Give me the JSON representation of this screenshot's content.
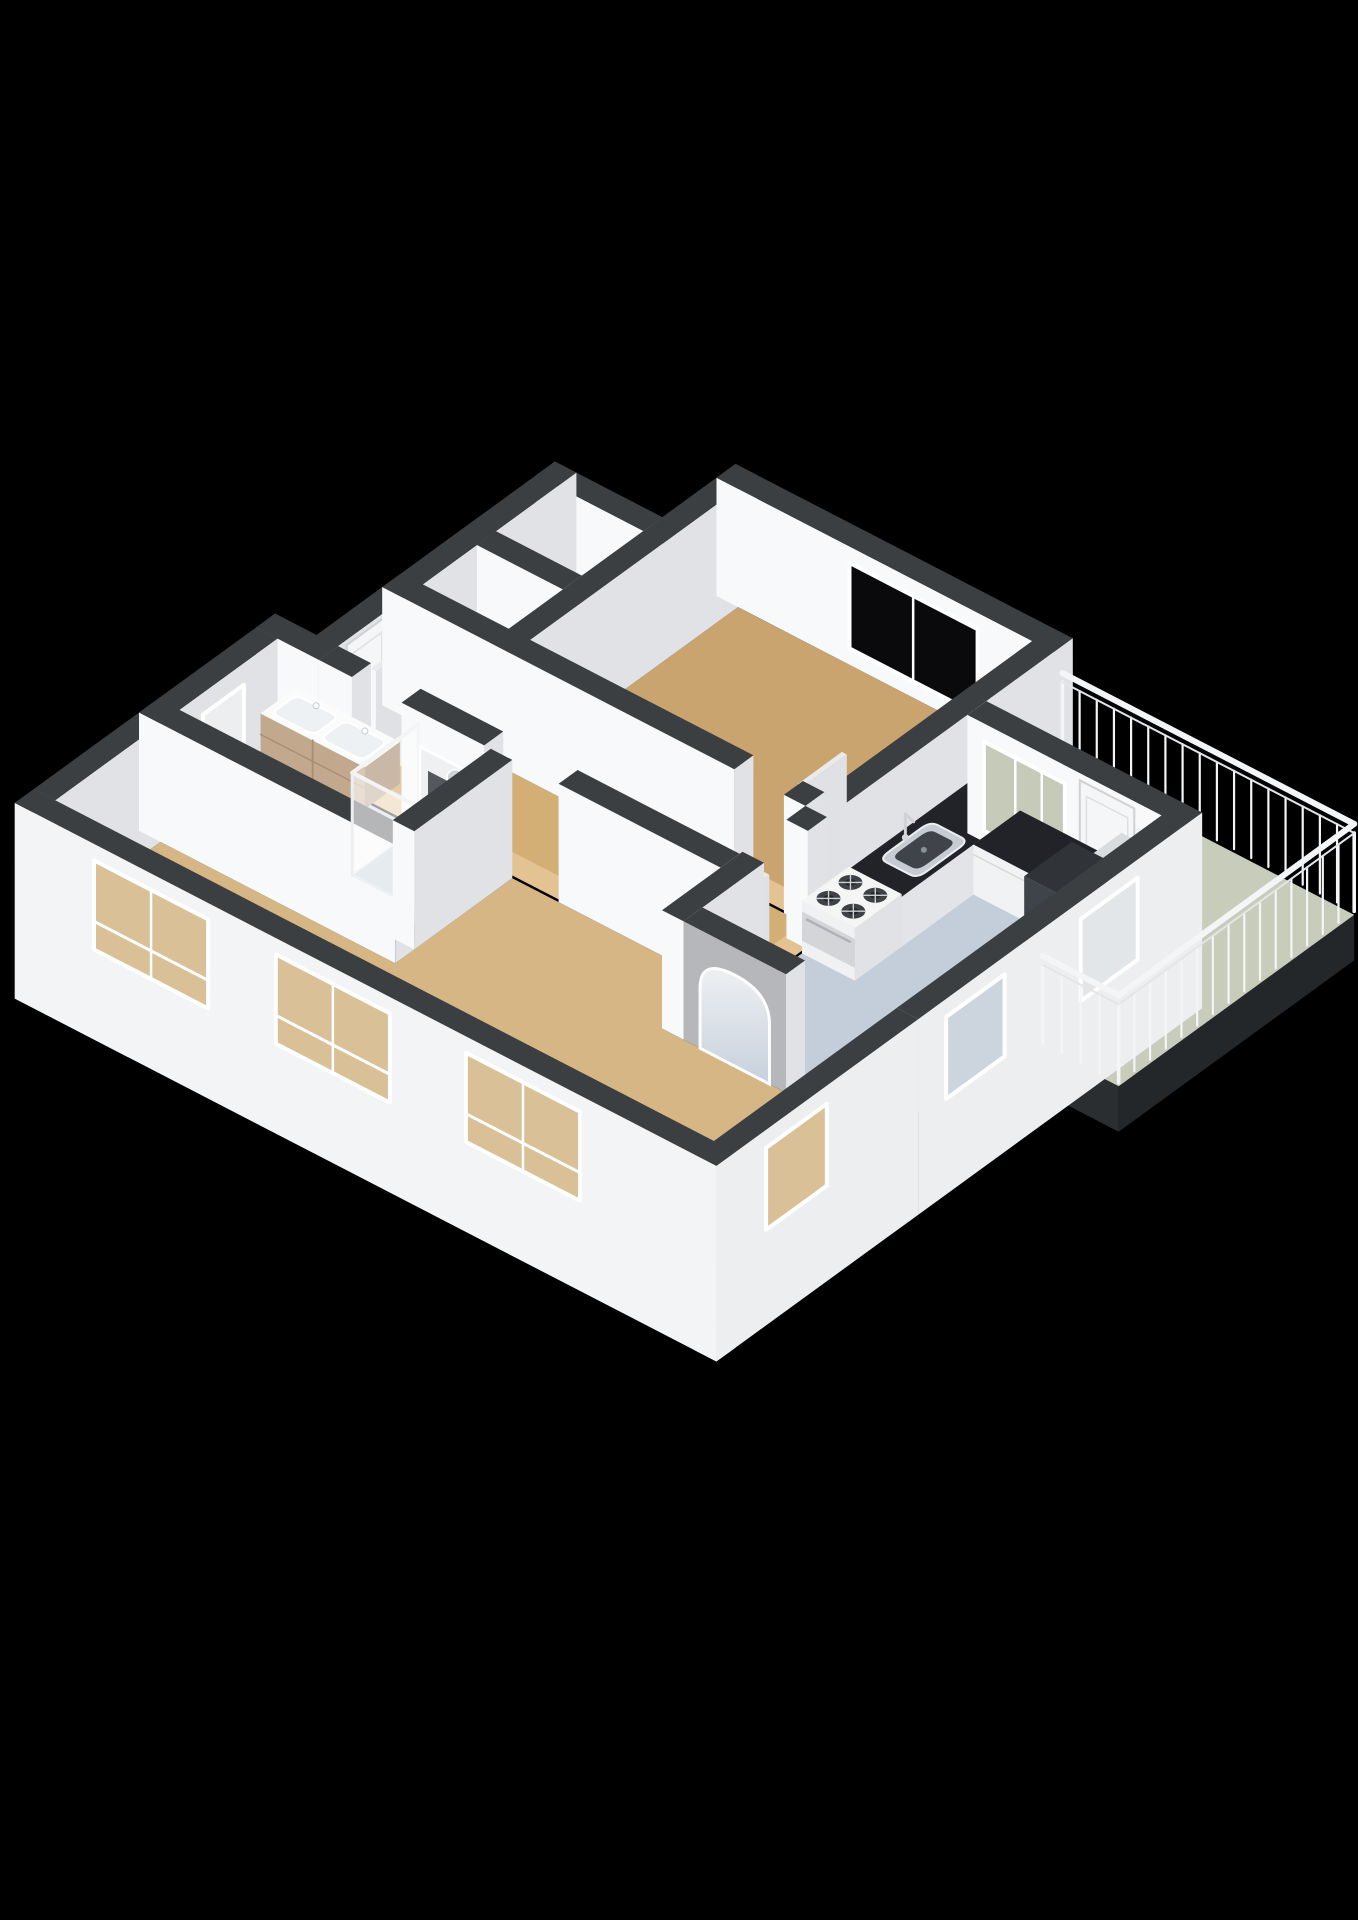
{
  "view": {
    "type": "3d-floorplan-render",
    "background": "#000000",
    "canvas_width": 1358,
    "canvas_height": 1920
  },
  "colors": {
    "wall_cap": "#3c3f42",
    "wall_cap_dark": "#33363a",
    "wall_face_south": "#f8f9fa",
    "wall_face_east": "#e0e2e5",
    "wall_exterior_south": "#f3f4f5",
    "wall_exterior_east": "#eceef0",
    "slab_dark": "#24272a",
    "floor_bedroom": "#c9a46e",
    "floor_hall": "#d3af75",
    "floor_living": "#d6b685",
    "floor_kitchen": "#c4ceda",
    "floor_bathroom": "#ccd6e1",
    "floor_balcony": "#c8ccbb",
    "floor_closet_a": "#e7e8ea",
    "floor_closet_b": "#dddee1",
    "threshold": "#e3c391",
    "glass_dark": "#0a0a0c",
    "glass_pale": "#e2e6e9",
    "glass_blue": "#ccd5de",
    "glass_tan": "#d9c096",
    "glass_sage": "#c6cab9",
    "glass_white": "#eceeef",
    "frame_white": "#ffffff",
    "door_white": "#f5f6f7",
    "counter_top": "#212329",
    "counter_front": "#f1f2f3",
    "steel": "#c7ccd2",
    "steel_dark": "#40444a",
    "stove_top": "#f4f5f5",
    "burner": "#3e4246",
    "wood_vanity": "#c2a98e",
    "wood_vanity_side": "#ad9376",
    "tub_white": "#f3f5f6",
    "tub_inner": "#e0e5e8",
    "pad_gray": "#8e959b",
    "railing_white": "#f4f5f6",
    "arch_face": "#b5b7ba"
  },
  "scene": {
    "floors": [
      {
        "name": "floor-bedroom",
        "colorKey": "floor_bedroom",
        "poly": [
          [
            2.6,
            0.3
          ],
          [
            6.16,
            0.3
          ],
          [
            6.16,
            3.14
          ],
          [
            2.6,
            3.14
          ]
        ]
      },
      {
        "name": "floor-closet-a",
        "colorKey": "floor_closet_a",
        "poly": [
          [
            1.3,
            1.3
          ],
          [
            2.34,
            1.3
          ],
          [
            2.34,
            2.14
          ],
          [
            1.3,
            2.14
          ]
        ]
      },
      {
        "name": "floor-closet-b",
        "colorKey": "floor_closet_b",
        "poly": [
          [
            1.3,
            2.4
          ],
          [
            2.34,
            2.4
          ],
          [
            2.34,
            3.14
          ],
          [
            1.3,
            3.14
          ]
        ]
      },
      {
        "name": "floor-hall",
        "colorKey": "floor_hall",
        "poly": [
          [
            1.3,
            3.4
          ],
          [
            6.16,
            3.4
          ],
          [
            6.16,
            4.3
          ],
          [
            1.3,
            4.3
          ]
        ]
      },
      {
        "name": "floor-kitchen",
        "colorKey": "floor_kitchen",
        "poly": [
          [
            6.42,
            1.48
          ],
          [
            8.77,
            1.48
          ],
          [
            8.77,
            5.36
          ],
          [
            7.66,
            5.36
          ],
          [
            7.66,
            5.1
          ],
          [
            6.42,
            5.1
          ]
        ]
      },
      {
        "name": "floor-living",
        "colorKey": "floor_living",
        "poly": [
          [
            3.64,
            4.56
          ],
          [
            6.16,
            4.56
          ],
          [
            6.16,
            5.36
          ],
          [
            8.77,
            5.36
          ],
          [
            8.77,
            7.6
          ],
          [
            0.8,
            7.6
          ],
          [
            0.8,
            6.16
          ],
          [
            3.64,
            6.16
          ]
        ]
      },
      {
        "name": "floor-bathroom",
        "colorKey": "floor_bathroom",
        "poly": [
          [
            0.8,
            4.56
          ],
          [
            3.38,
            4.56
          ],
          [
            3.38,
            5.9
          ],
          [
            0.8,
            5.9
          ]
        ]
      }
    ],
    "balcony": {
      "name": "floor-balcony",
      "poly": [
        [
          6.42,
          0.18
        ],
        [
          9.95,
          0.18
        ],
        [
          9.95,
          3.4
        ],
        [
          9.03,
          3.4
        ],
        [
          9.03,
          1.22
        ],
        [
          6.42,
          1.22
        ]
      ],
      "slabDepth": 0.5
    },
    "thresholds": [
      {
        "name": "threshold-bedroom-door",
        "x1": 5.3,
        "y1": 3.14,
        "x2": 5.9,
        "y2": 3.4
      },
      {
        "name": "threshold-kitchen-door",
        "x1": 6.16,
        "y1": 3.66,
        "x2": 6.42,
        "y2": 4.26
      },
      {
        "name": "threshold-bathroom-door",
        "x1": 1.7,
        "y1": 4.3,
        "x2": 2.3,
        "y2": 4.56
      },
      {
        "name": "threshold-living-opening",
        "x1": 3.3,
        "y1": 4.3,
        "x2": 4.2,
        "y2": 4.56
      }
    ],
    "walls": [
      {
        "name": "wall-bedroom-north",
        "x1": 2.34,
        "y1": 0.04,
        "x2": 6.42,
        "y2": 0.3,
        "features": [
          {
            "face": "s",
            "type": "window",
            "a1": 3.95,
            "a2": 5.5,
            "z1": 0.18,
            "z2": 1.12,
            "glassKey": "glass_dark",
            "mull": [
              4.72
            ]
          }
        ]
      },
      {
        "name": "wall-bedroom-west",
        "x1": 2.34,
        "y1": 0.04,
        "x2": 2.6,
        "y2": 3.4
      },
      {
        "name": "wall-closet-north",
        "x1": 1.04,
        "y1": 1.04,
        "x2": 2.34,
        "y2": 1.3
      },
      {
        "name": "wall-hall-west",
        "x1": 1.04,
        "y1": 1.04,
        "x2": 1.3,
        "y2": 4.56,
        "features": [
          {
            "face": "e",
            "type": "door",
            "a1": 3.62,
            "a2": 4.18,
            "z1": 0.0,
            "z2": 1.24
          }
        ]
      },
      {
        "name": "wall-closet-divider",
        "x1": 1.3,
        "y1": 2.14,
        "x2": 2.34,
        "y2": 2.4
      },
      {
        "name": "wall-bedroom-south",
        "x1": 1.04,
        "y1": 3.14,
        "x2": 5.3,
        "y2": 3.4
      },
      {
        "name": "wall-bedroom-south-jamb",
        "x1": 5.9,
        "y1": 3.14,
        "x2": 6.16,
        "y2": 3.4
      },
      {
        "name": "wall-bedroom-east",
        "x1": 6.16,
        "y1": 0.04,
        "x2": 6.42,
        "y2": 3.4
      },
      {
        "name": "wall-kitchen-west-a",
        "x1": 6.16,
        "y1": 3.4,
        "x2": 6.42,
        "y2": 3.66
      },
      {
        "name": "wall-kitchen-west-b",
        "x1": 6.16,
        "y1": 4.26,
        "x2": 6.42,
        "y2": 5.36
      },
      {
        "name": "wall-hall-south-a",
        "x1": 1.3,
        "y1": 4.3,
        "x2": 1.7,
        "y2": 4.56
      },
      {
        "name": "wall-hall-south-b",
        "x1": 2.3,
        "y1": 4.3,
        "x2": 3.3,
        "y2": 4.56,
        "features": [
          {
            "face": "s",
            "type": "niche",
            "a1": 2.52,
            "a2": 3.08,
            "z1": 0.18,
            "z2": 0.92
          }
        ]
      },
      {
        "name": "wall-hall-south-c",
        "x1": 4.2,
        "y1": 4.3,
        "x2": 6.16,
        "y2": 4.56
      },
      {
        "name": "wall-bathroom-northwest",
        "x1": 0.54,
        "y1": 4.3,
        "x2": 1.3,
        "y2": 4.56
      },
      {
        "name": "wall-bathroom-west",
        "x1": 0.54,
        "y1": 4.56,
        "x2": 0.8,
        "y2": 6.16,
        "features": [
          {
            "face": "e",
            "type": "window",
            "a1": 5.02,
            "a2": 5.58,
            "z1": 0.42,
            "z2": 1.06,
            "glassKey": "glass_white"
          }
        ]
      },
      {
        "name": "wall-bathroom-south",
        "x1": 0.54,
        "y1": 5.9,
        "x2": 3.64,
        "y2": 6.16
      },
      {
        "name": "wall-bathroom-east",
        "x1": 3.38,
        "y1": 4.56,
        "x2": 3.64,
        "y2": 5.9
      },
      {
        "name": "wall-living-west",
        "x1": 0.54,
        "y1": 6.16,
        "x2": 0.8,
        "y2": 7.6
      },
      {
        "name": "wall-living-southwest",
        "x1": 0.54,
        "y1": 7.6,
        "x2": 9.03,
        "y2": 7.86,
        "zmin": -0.85,
        "exterior": true,
        "features": [
          {
            "face": "s",
            "type": "window",
            "a1": 1.5,
            "a2": 2.88,
            "z1": 0.14,
            "z2": 1.12,
            "glassKey": "glass_tan",
            "mull": [
              2.19
            ],
            "rail": 0.45
          },
          {
            "face": "s",
            "type": "window",
            "a1": 3.7,
            "a2": 5.08,
            "z1": 0.14,
            "z2": 1.12,
            "glassKey": "glass_tan",
            "mull": [
              4.39
            ],
            "rail": 0.45
          },
          {
            "face": "s",
            "type": "window",
            "a1": 6.0,
            "a2": 7.38,
            "z1": 0.14,
            "z2": 1.12,
            "glassKey": "glass_tan",
            "mull": [
              6.69
            ],
            "rail": 0.45
          }
        ]
      },
      {
        "name": "wall-east-north",
        "x1": 8.77,
        "y1": 1.22,
        "x2": 9.03,
        "y2": 5.1,
        "zmin": -0.85,
        "exterior": true,
        "features": [
          {
            "face": "e",
            "type": "window",
            "a1": 2.1,
            "a2": 2.88,
            "z1": 0.2,
            "z2": 1.1,
            "glassKey": "glass_pale"
          },
          {
            "face": "e",
            "type": "window",
            "a1": 3.92,
            "a2": 4.72,
            "z1": 0.2,
            "z2": 1.1,
            "glassKey": "glass_blue"
          }
        ]
      },
      {
        "name": "wall-east-south",
        "x1": 8.77,
        "y1": 5.1,
        "x2": 9.03,
        "y2": 7.86,
        "zmin": -0.85,
        "exterior": true,
        "features": [
          {
            "face": "e",
            "type": "window",
            "a1": 6.35,
            "a2": 7.18,
            "z1": 0.2,
            "z2": 1.1,
            "glassKey": "glass_tan"
          }
        ]
      },
      {
        "name": "wall-kitchen-north",
        "x1": 6.42,
        "y1": 1.22,
        "x2": 9.03,
        "y2": 1.48,
        "features": [
          {
            "face": "s",
            "type": "glazing",
            "a1": 6.62,
            "a2": 7.6,
            "z1": 0.12,
            "z2": 1.1,
            "glassKey": "glass_sage",
            "mull": [
              7.0,
              7.32
            ]
          },
          {
            "face": "s",
            "type": "door",
            "a1": 7.78,
            "a2": 8.44,
            "z1": 0.0,
            "z2": 1.22
          }
        ]
      },
      {
        "name": "wall-arch",
        "x1": 6.42,
        "y1": 5.1,
        "x2": 7.66,
        "y2": 5.36,
        "fSKey": "arch_face",
        "features": [
          {
            "face": "s",
            "type": "arch",
            "a1": 6.62,
            "a2": 7.46,
            "top": 1.0
          }
        ]
      }
    ],
    "railings": [
      {
        "name": "railing-balcony-north",
        "x1": 6.42,
        "y1": 0.18,
        "x2": 9.95,
        "y2": 0.18
      },
      {
        "name": "railing-balcony-east",
        "x1": 9.95,
        "y1": 0.18,
        "x2": 9.95,
        "y2": 3.4
      },
      {
        "name": "railing-balcony-return",
        "x1": 9.95,
        "y1": 3.4,
        "x2": 9.03,
        "y2": 3.4
      }
    ],
    "furniture": [
      {
        "type": "counter",
        "name": "kitchen-counter-long",
        "x1": 6.42,
        "y1": 1.48,
        "x2": 7.06,
        "y2": 3.1,
        "sink": {
          "x1": 6.54,
          "y1": 2.12,
          "x2": 7.0,
          "y2": 2.82
        },
        "faucet": [
          6.52,
          2.44
        ]
      },
      {
        "type": "counter",
        "name": "kitchen-counter-short",
        "x1": 7.06,
        "y1": 1.48,
        "x2": 8.3,
        "y2": 2.12
      },
      {
        "type": "stove",
        "name": "gas-stove",
        "x1": 6.42,
        "y1": 3.1,
        "x2": 7.06,
        "y2": 3.74
      },
      {
        "type": "box",
        "name": "kitchen-tall-cabinet",
        "x1": 8.32,
        "y1": 2.2,
        "x2": 8.77,
        "y2": 2.85,
        "z1": 1.22,
        "cap": "#303338",
        "fS": "#3f434a",
        "fE": "#23262a"
      },
      {
        "type": "box",
        "name": "kitchen-low-cabinet",
        "x1": 8.32,
        "y1": 1.52,
        "x2": 8.77,
        "y2": 2.16,
        "z1": 0.92,
        "cap": "#d9dcdf",
        "fS": "#f2f3f4",
        "fE": "#e3e5e8"
      },
      {
        "type": "vanity",
        "name": "bathroom-vanity-double-sink",
        "x1": 1.02,
        "y1": 4.56,
        "x2": 2.28,
        "y2": 5.04
      },
      {
        "type": "tub",
        "name": "bathtub",
        "x1": 0.84,
        "y1": 5.3,
        "x2": 2.36,
        "y2": 5.88
      },
      {
        "type": "shower",
        "name": "shower-cabin",
        "x1": 2.5,
        "y1": 4.56,
        "x2": 3.38,
        "y2": 5.46
      },
      {
        "type": "leaf",
        "name": "bedroom-door-leaf",
        "x1": 5.84,
        "y1": 2.54,
        "x2": 5.9,
        "y2": 3.14
      },
      {
        "type": "leaf",
        "name": "bathroom-door-leaf",
        "x1": 1.7,
        "y1": 3.72,
        "x2": 1.76,
        "y2": 4.3
      },
      {
        "type": "leaf",
        "name": "kitchen-door-leaf",
        "x1": 6.46,
        "y1": 4.3,
        "x2": 6.52,
        "y2": 4.88
      }
    ]
  }
}
